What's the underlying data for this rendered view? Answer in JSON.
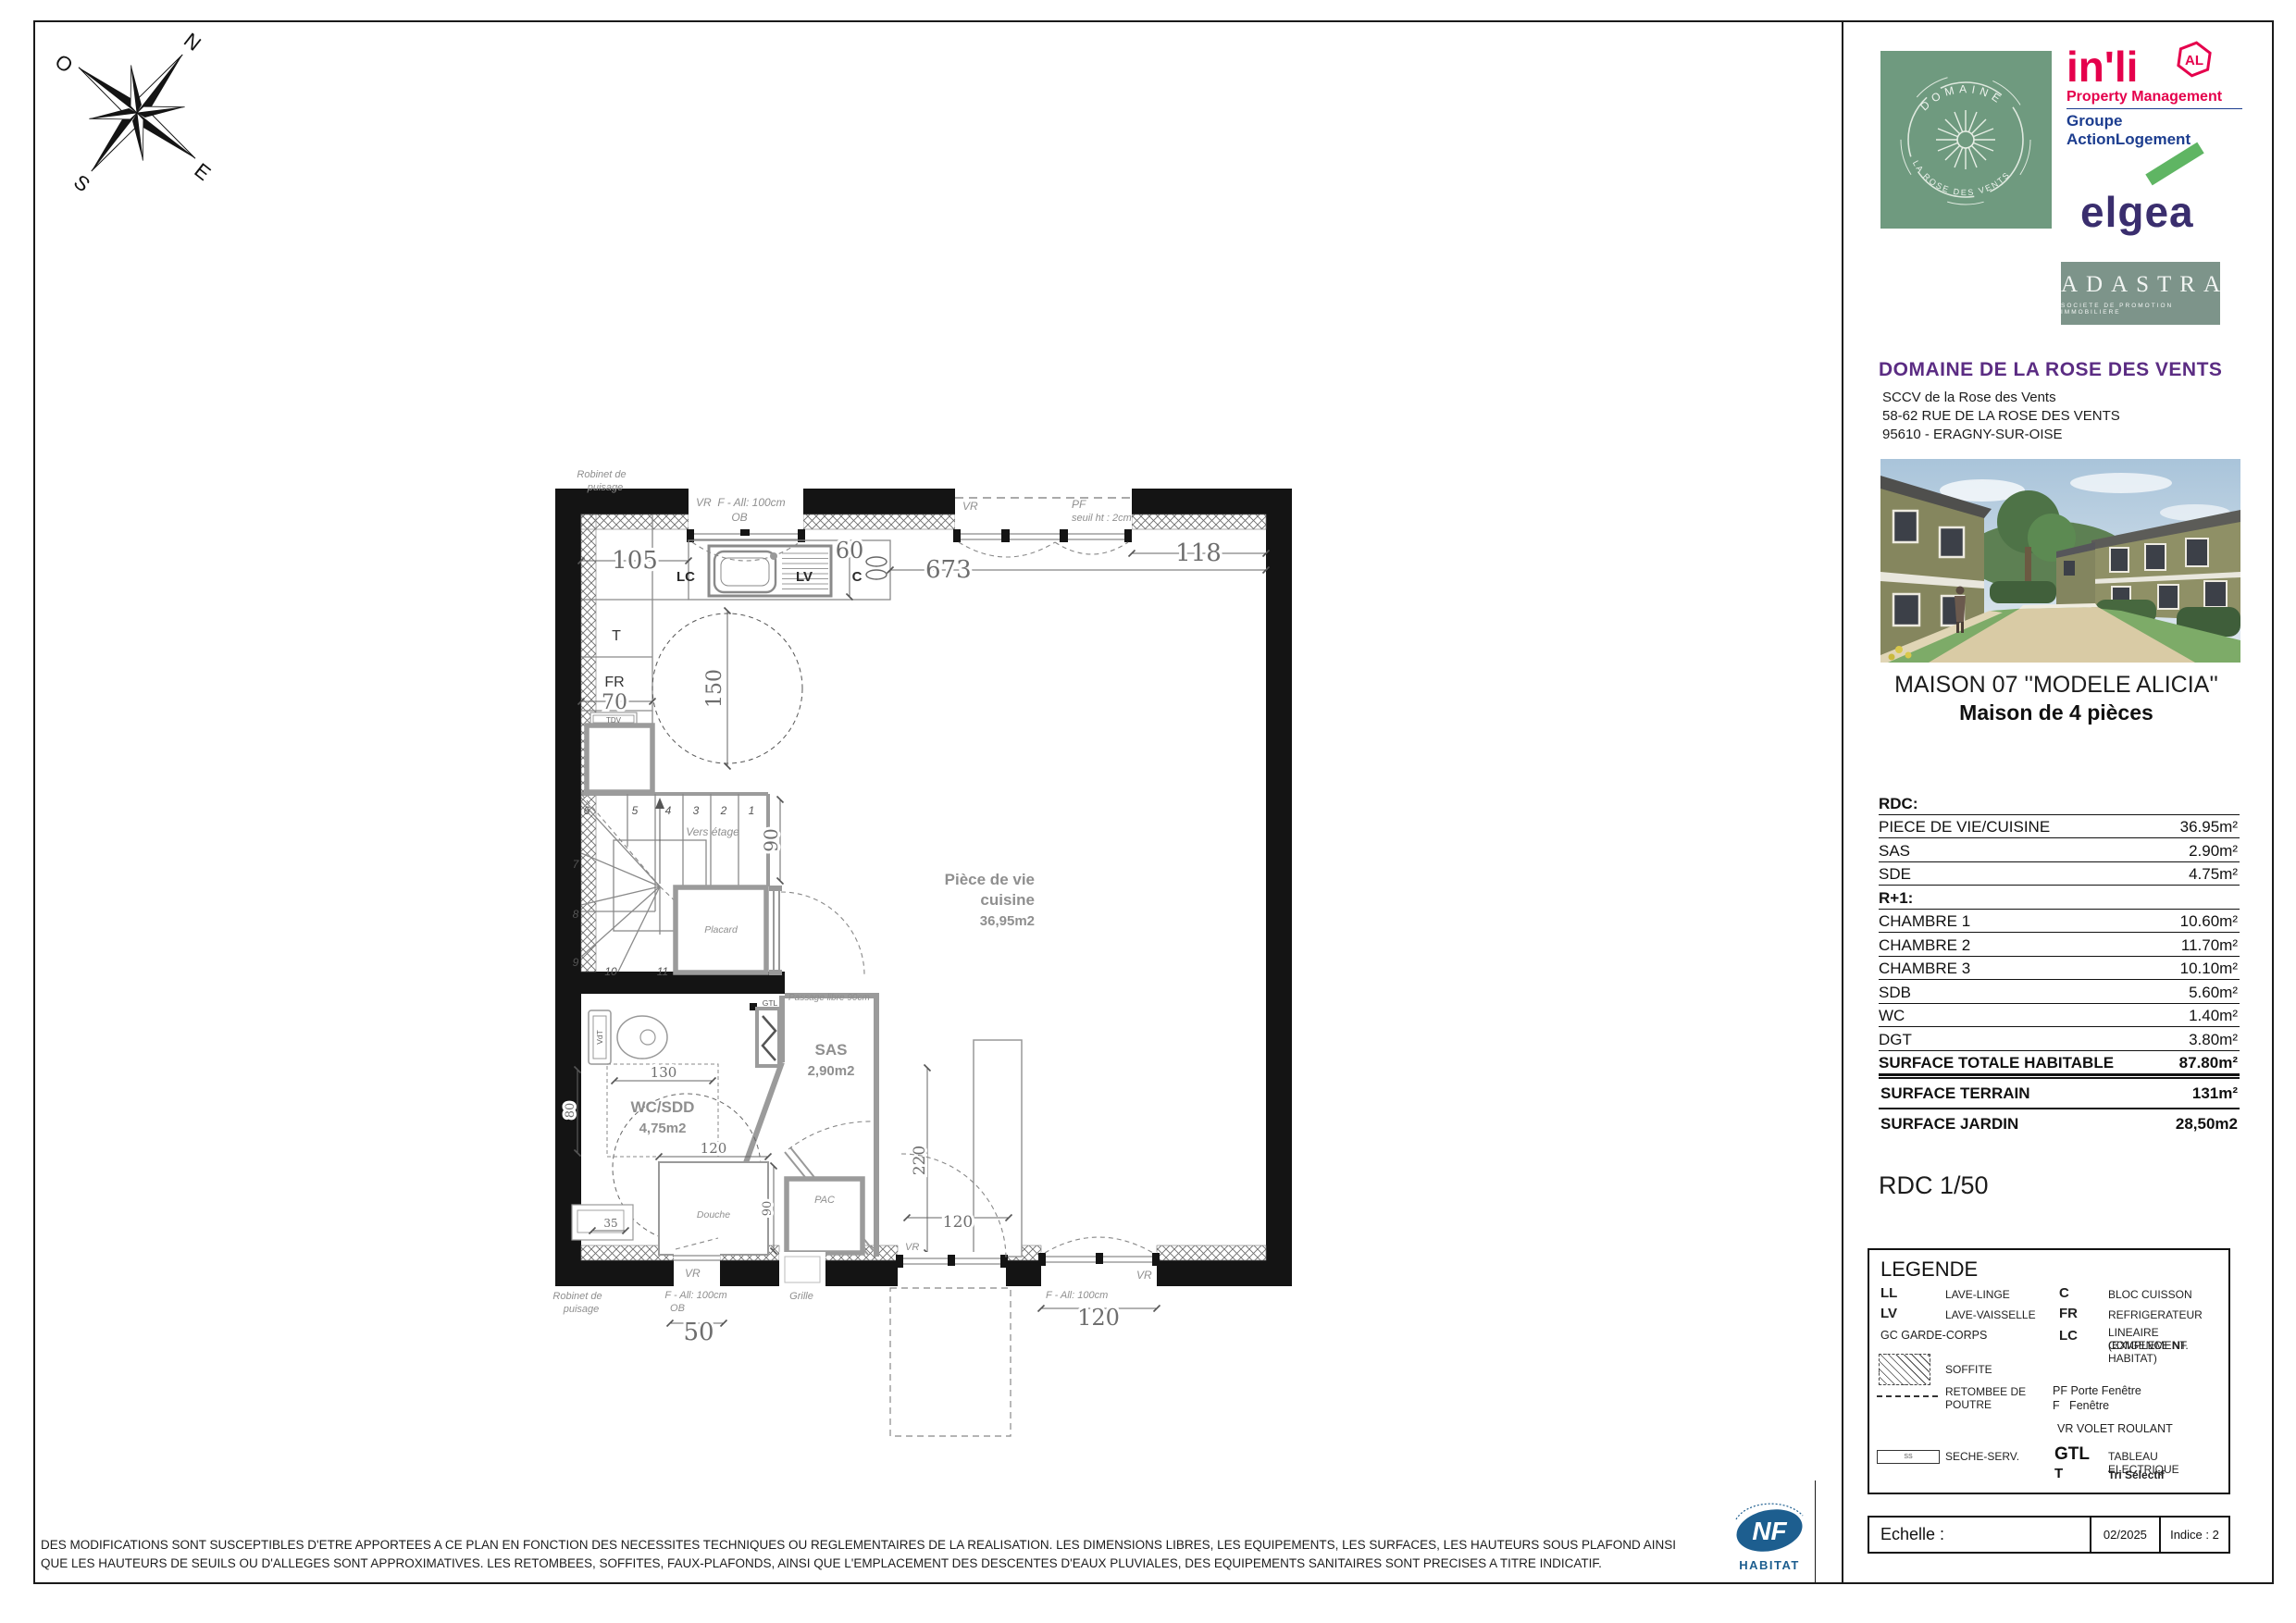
{
  "compass": {
    "n": "N",
    "e": "E",
    "s": "S",
    "o": "O"
  },
  "logos": {
    "domaine": {
      "top": "DOMAINE",
      "bottom": "LA ROSE DES VENTS"
    },
    "inli": {
      "name": "in'li",
      "badge": "AL",
      "tagline": "Property Management",
      "group": "Groupe ActionLogement"
    },
    "elgea": {
      "name": "elgea"
    },
    "adastra": {
      "name": "ADASTRA",
      "subtitle": "SOCIETE DE PROMOTION IMMOBILIERE"
    }
  },
  "project": {
    "title": "DOMAINE DE LA ROSE DES VENTS",
    "line1": "SCCV de la Rose des Vents",
    "line2": "58-62 RUE DE LA ROSE DES VENTS",
    "line3": "95610 - ERAGNY-SUR-OISE"
  },
  "unit": {
    "title": "MAISON 07 ''MODELE ALICIA''",
    "subtitle": "Maison de 4 pièces"
  },
  "surfaces": {
    "rdc_header": "RDC:",
    "rdc_rows": [
      {
        "label": "PIECE DE VIE/CUISINE",
        "value": "36.95m²"
      },
      {
        "label": "SAS",
        "value": "2.90m²"
      },
      {
        "label": "SDE",
        "value": "4.75m²"
      }
    ],
    "r1_header": "R+1:",
    "r1_rows": [
      {
        "label": "CHAMBRE 1",
        "value": "10.60m²"
      },
      {
        "label": "CHAMBRE 2",
        "value": "11.70m²"
      },
      {
        "label": "CHAMBRE 3",
        "value": "10.10m²"
      },
      {
        "label": "SDB",
        "value": "5.60m²"
      },
      {
        "label": "WC",
        "value": "1.40m²"
      },
      {
        "label": "DGT",
        "value": "3.80m²"
      }
    ],
    "total": {
      "label": "SURFACE TOTALE HABITABLE",
      "value": "87.80m²"
    },
    "terrain": {
      "label": "SURFACE TERRAIN",
      "value": "131m²"
    },
    "jardin": {
      "label": "SURFACE JARDIN",
      "value": "28,50m2"
    }
  },
  "scale_label": "RDC 1/50",
  "legend": {
    "title": "LEGENDE",
    "ll": "LL",
    "ll_d": "LAVE-LINGE",
    "lv": "LV",
    "lv_d": "LAVE-VAISSELLE",
    "gc": "GC GARDE-CORPS",
    "soffite": "SOFFITE",
    "retombee1": "RETOMBEE DE",
    "retombee2": "POUTRE",
    "ss": "SS",
    "seche": "SECHE-SERV.",
    "c": "C",
    "c_d": "BLOC CUISSON",
    "fr": "FR",
    "fr_d": "REFRIGERATEUR",
    "lc": "LC",
    "lc_d1": "LINEAIRE COMPLEMENT.",
    "lc_d2": "(EXIGENCE NF HABITAT)",
    "pf": "PF Porte Fenêtre",
    "f": "F   Fenêtre",
    "vr": "VR VOLET ROULANT",
    "gtl": "GTL",
    "gtl_d": "TABLEAU ELECTRIQUE",
    "t": "T",
    "t_d": "Tri Sélectif"
  },
  "titleblock": {
    "echelle": "Echelle :",
    "date": "02/2025",
    "indice": "Indice : 2"
  },
  "footer": {
    "line1": "DES MODIFICATIONS SONT SUSCEPTIBLES D'ETRE APPORTEES A CE PLAN EN FONCTION DES NECESSITES TECHNIQUES OU REGLEMENTAIRES DE LA REALISATION. LES DIMENSIONS LIBRES, LES EQUIPEMENTS, LES SURFACES, LES HAUTEURS SOUS PLAFOND AINSI",
    "line2": "QUE LES HAUTEURS DE SEUILS OU D'ALLEGES SONT APPROXIMATIVES. LES RETOMBEES, SOFFITES, FAUX-PLAFONDS, AINSI QUE L'EMPLACEMENT DES DESCENTES D'EAUX PLUVIALES, DES EQUIPEMENTS SANITAIRES SONT PRECISES A TITRE INDICATIF.",
    "nf": "NF",
    "habitat": "HABITAT"
  },
  "plan": {
    "robinet1": "Robinet de",
    "robinet2": "puisage",
    "win_top": {
      "vr": "VR",
      "f": "F - All: 100cm",
      "ob": "OB"
    },
    "bay": {
      "vr": "VR",
      "pf": "PF",
      "seuil": "seuil ht : 2cm"
    },
    "kitchen": {
      "lc": "LC",
      "lv": "LV",
      "c": "C",
      "t": "T",
      "fr": "FR",
      "tdv": "TDV"
    },
    "dims": {
      "d105": "105",
      "d60": "60",
      "d673": "673",
      "d118": "118",
      "d150": "150",
      "d70": "70",
      "d90": "90",
      "d130": "130",
      "d80": "80",
      "d35": "35",
      "d120": "120",
      "d50": "50",
      "d220": "220"
    },
    "stairs": {
      "vers": "Vers étage",
      "n": [
        "1",
        "2",
        "3",
        "4",
        "5",
        "6",
        "7",
        "8",
        "9",
        "10",
        "11"
      ]
    },
    "placard": "Placard",
    "passage": "Passage libre 90cm",
    "gtl": "GTL",
    "living": {
      "l1": "Pièce de vie",
      "l2": "cuisine",
      "area": "36,95m2"
    },
    "sas": {
      "name": "SAS",
      "area": "2,90m2"
    },
    "wc": {
      "name": "WC/SDD",
      "area": "4,75m2"
    },
    "douche": "Douche",
    "pac": "PAC",
    "grille": "Grille",
    "vdt": "VdT",
    "win_bottom": {
      "vr": "VR",
      "f": "F - All: 100cm",
      "ob": "OB"
    },
    "door_bottom": {
      "vr": "VR"
    },
    "win_right": {
      "vr": "VR",
      "f": "F - All: 100cm"
    }
  }
}
